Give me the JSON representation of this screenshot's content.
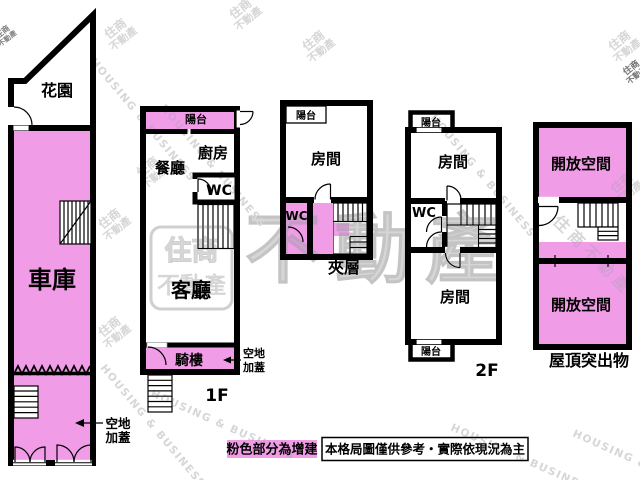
{
  "colors": {
    "addition_pink": "#F19CE6",
    "wall_black": "#000000",
    "watermark_gray": "#CFCFCF",
    "stamp_red": "#D4868F"
  },
  "floors": {
    "garage_unit": {
      "garden": "花園",
      "garage": "車庫",
      "annotation_line1": "空地",
      "annotation_line2": "加蓋"
    },
    "first_floor": {
      "balcony": "陽台",
      "kitchen": "廚房",
      "dining_room": "餐廳",
      "wc": "WC",
      "living_room": "客廳",
      "arcade": "騎樓",
      "annotation_line1": "空地",
      "annotation_line2": "加蓋",
      "label": "1F"
    },
    "mezzanine": {
      "balcony": "陽台",
      "room": "房間",
      "wc": "WC",
      "label": "夾層"
    },
    "second_floor": {
      "balcony_top": "陽台",
      "room_top": "房間",
      "wc": "WC",
      "room_bottom": "房間",
      "balcony_bottom": "陽台",
      "label": "2F"
    },
    "roof": {
      "open_space_top": "開放空間",
      "open_space_bottom": "開放空間",
      "label": "屋頂突出物"
    }
  },
  "legend": {
    "pink_note": "粉色部分為增建",
    "disclaimer": "本格局圖僅供參考・實際依現況為主"
  },
  "watermark": {
    "brand": "住商不動產",
    "brand_short_top": "住商",
    "brand_short_bottom": "不動產",
    "brand_en": "HOUSING & BUSINESS"
  }
}
